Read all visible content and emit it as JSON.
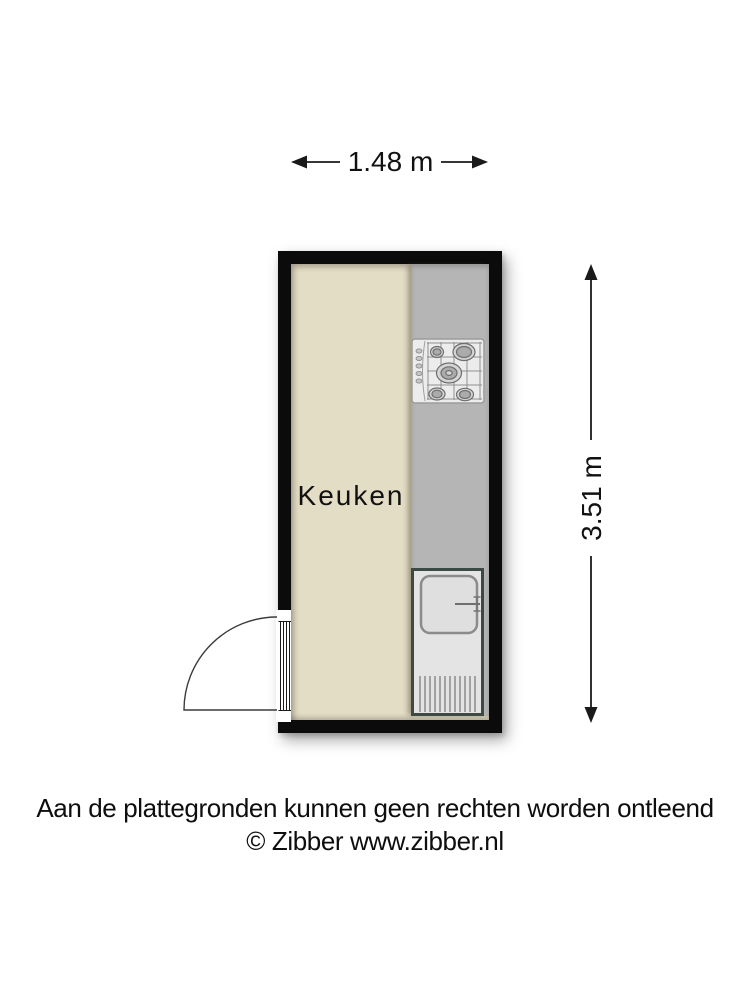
{
  "floorplan": {
    "room_label": "Keuken",
    "dimensions": {
      "width_label": "1.48 m",
      "height_label": "3.51 m"
    },
    "colors": {
      "wall": "#0b0b0b",
      "floor": "#e4ddc5",
      "counter": "#b5b5b5",
      "fixture_fill": "#ececec",
      "sink_fill": "#e4e4e4",
      "sink_outline": "#3d4a43",
      "dimension_line": "#1a1a1a"
    },
    "fixtures": [
      {
        "name": "gas-hob",
        "burners": 5,
        "location": "counter-top"
      },
      {
        "name": "sink-unit",
        "parts": [
          "basin",
          "faucet",
          "drainer"
        ],
        "location": "counter-bottom"
      },
      {
        "name": "door",
        "swing": "outward",
        "location": "left-wall-bottom"
      }
    ]
  },
  "footer": {
    "disclaimer": "Aan de plattegronden kunnen geen rechten worden ontleend",
    "copyright": "© Zibber www.zibber.nl"
  }
}
